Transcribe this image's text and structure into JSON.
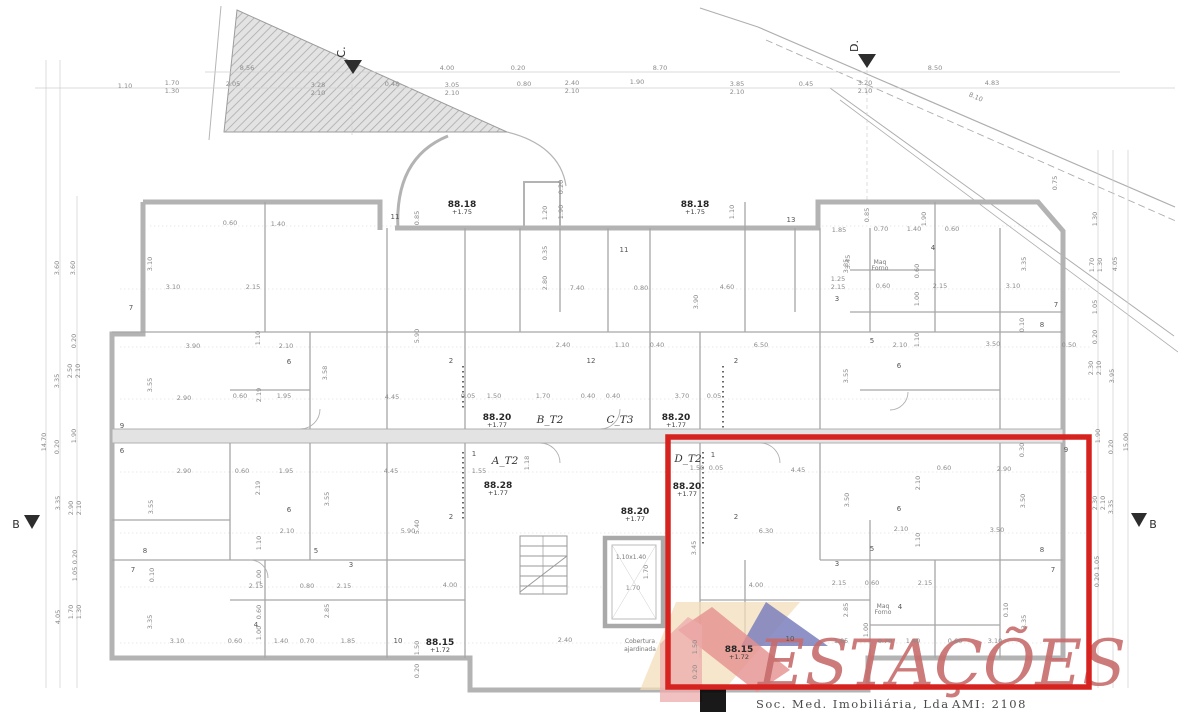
{
  "page": {
    "background": "#ffffff"
  },
  "highlight": {
    "color": "#d6231f"
  },
  "section_markers": {
    "c": "C.",
    "d": "D.",
    "b_left": "B",
    "b_right": "B"
  },
  "logo": {
    "name": "ESTAÇÕES",
    "line1": "Soc. Med. Imobiliária, Lda",
    "line2": "AMI: 2108",
    "colors": {
      "text": "#c76c6c",
      "roof_blue": "#7b7fbc",
      "roof_red": "#e5908f",
      "roof_tan": "#f2ddb9",
      "wall_pink": "#ecabab"
    }
  },
  "plan": {
    "elevation_labels": [
      {
        "x": 462,
        "y": 207,
        "v": "88.18",
        "s": "+1.75"
      },
      {
        "x": 695,
        "y": 207,
        "v": "88.18",
        "s": "+1.75"
      },
      {
        "x": 497,
        "y": 420,
        "v": "88.20",
        "s": "+1.77"
      },
      {
        "x": 676,
        "y": 420,
        "v": "88.20",
        "s": "+1.77"
      },
      {
        "x": 498,
        "y": 488,
        "v": "88.28",
        "s": "+1.77"
      },
      {
        "x": 687,
        "y": 489,
        "v": "88.20",
        "s": "+1.77"
      },
      {
        "x": 635,
        "y": 514,
        "v": "88.20",
        "s": "+1.77"
      },
      {
        "x": 440,
        "y": 645,
        "v": "88.15",
        "s": "+1.72"
      },
      {
        "x": 739,
        "y": 652,
        "v": "88.15",
        "s": "+1.72"
      }
    ],
    "apartment_labels": [
      {
        "x": 505,
        "y": 464,
        "t": "A_T2"
      },
      {
        "x": 550,
        "y": 423,
        "t": "B_T2"
      },
      {
        "x": 620,
        "y": 423,
        "t": "C_T3"
      },
      {
        "x": 688,
        "y": 462,
        "t": "D_T2"
      }
    ],
    "room_numbers": [
      {
        "x": 131,
        "y": 310,
        "t": "7"
      },
      {
        "x": 395,
        "y": 219,
        "t": "11"
      },
      {
        "x": 624,
        "y": 252,
        "t": "11"
      },
      {
        "x": 791,
        "y": 222,
        "t": "13"
      },
      {
        "x": 591,
        "y": 363,
        "t": "12"
      },
      {
        "x": 736,
        "y": 363,
        "t": "2"
      },
      {
        "x": 837,
        "y": 301,
        "t": "3"
      },
      {
        "x": 933,
        "y": 250,
        "t": "4"
      },
      {
        "x": 1056,
        "y": 307,
        "t": "7"
      },
      {
        "x": 1042,
        "y": 327,
        "t": "8"
      },
      {
        "x": 872,
        "y": 343,
        "t": "5"
      },
      {
        "x": 899,
        "y": 368,
        "t": "6"
      },
      {
        "x": 122,
        "y": 428,
        "t": "9"
      },
      {
        "x": 122,
        "y": 453,
        "t": "6"
      },
      {
        "x": 289,
        "y": 364,
        "t": "6"
      },
      {
        "x": 451,
        "y": 363,
        "t": "2"
      },
      {
        "x": 474,
        "y": 456,
        "t": "1"
      },
      {
        "x": 451,
        "y": 519,
        "t": "2"
      },
      {
        "x": 289,
        "y": 512,
        "t": "6"
      },
      {
        "x": 316,
        "y": 553,
        "t": "5"
      },
      {
        "x": 351,
        "y": 567,
        "t": "3"
      },
      {
        "x": 145,
        "y": 553,
        "t": "8"
      },
      {
        "x": 133,
        "y": 572,
        "t": "7"
      },
      {
        "x": 256,
        "y": 627,
        "t": "4"
      },
      {
        "x": 398,
        "y": 643,
        "t": "10"
      },
      {
        "x": 713,
        "y": 457,
        "t": "1"
      },
      {
        "x": 736,
        "y": 519,
        "t": "2"
      },
      {
        "x": 899,
        "y": 511,
        "t": "6"
      },
      {
        "x": 872,
        "y": 551,
        "t": "5"
      },
      {
        "x": 837,
        "y": 566,
        "t": "3"
      },
      {
        "x": 1042,
        "y": 552,
        "t": "8"
      },
      {
        "x": 1053,
        "y": 572,
        "t": "7"
      },
      {
        "x": 1066,
        "y": 452,
        "t": "9"
      },
      {
        "x": 900,
        "y": 609,
        "t": "4"
      },
      {
        "x": 790,
        "y": 641,
        "t": "10"
      }
    ],
    "dimensions": [
      {
        "x": 125,
        "y": 88,
        "t": "1.10"
      },
      {
        "x": 172,
        "y": 85,
        "t": "1.70"
      },
      {
        "x": 172,
        "y": 93,
        "t": "1.30"
      },
      {
        "x": 233,
        "y": 86,
        "t": "2.05"
      },
      {
        "x": 247,
        "y": 70,
        "t": "8.56"
      },
      {
        "x": 318,
        "y": 87,
        "t": "3.28"
      },
      {
        "x": 318,
        "y": 95,
        "t": "2.10"
      },
      {
        "x": 392,
        "y": 86,
        "t": "0.48"
      },
      {
        "x": 447,
        "y": 70,
        "t": "4.00"
      },
      {
        "x": 452,
        "y": 87,
        "t": "3.05"
      },
      {
        "x": 452,
        "y": 95,
        "t": "2.10"
      },
      {
        "x": 518,
        "y": 70,
        "t": "0.20"
      },
      {
        "x": 524,
        "y": 86,
        "t": "0.80"
      },
      {
        "x": 572,
        "y": 85,
        "t": "2.40"
      },
      {
        "x": 572,
        "y": 93,
        "t": "2.10"
      },
      {
        "x": 637,
        "y": 84,
        "t": "1.90"
      },
      {
        "x": 660,
        "y": 70,
        "t": "8.70"
      },
      {
        "x": 737,
        "y": 86,
        "t": "3.85"
      },
      {
        "x": 737,
        "y": 94,
        "t": "2.10"
      },
      {
        "x": 806,
        "y": 86,
        "t": "0.45"
      },
      {
        "x": 865,
        "y": 85,
        "t": "3.20"
      },
      {
        "x": 865,
        "y": 93,
        "t": "2.10"
      },
      {
        "x": 935,
        "y": 70,
        "t": "8.50"
      },
      {
        "x": 992,
        "y": 85,
        "t": "4.83"
      },
      {
        "x": 975,
        "y": 99,
        "t": "8.10",
        "r": 23
      },
      {
        "x": 59,
        "y": 268,
        "t": "3.60",
        "r": -90
      },
      {
        "x": 75,
        "y": 268,
        "t": "3.60",
        "r": -90
      },
      {
        "x": 76,
        "y": 341,
        "t": "0.20",
        "r": -90
      },
      {
        "x": 72,
        "y": 371,
        "t": "2.50",
        "r": -90
      },
      {
        "x": 80,
        "y": 371,
        "t": "2.10",
        "r": -90
      },
      {
        "x": 59,
        "y": 381,
        "t": "3.35",
        "r": -90
      },
      {
        "x": 76,
        "y": 436,
        "t": "1.90",
        "r": -90
      },
      {
        "x": 59,
        "y": 447,
        "t": "0.20",
        "r": -90
      },
      {
        "x": 46,
        "y": 442,
        "t": "14.70",
        "r": -90
      },
      {
        "x": 60,
        "y": 503,
        "t": "3.35",
        "r": -90
      },
      {
        "x": 73,
        "y": 508,
        "t": "2.90",
        "r": -90
      },
      {
        "x": 81,
        "y": 508,
        "t": "2.10",
        "r": -90
      },
      {
        "x": 77,
        "y": 557,
        "t": "0.20",
        "r": -90
      },
      {
        "x": 77,
        "y": 574,
        "t": "1.05",
        "r": -90
      },
      {
        "x": 73,
        "y": 612,
        "t": "1.70",
        "r": -90
      },
      {
        "x": 81,
        "y": 612,
        "t": "1.30",
        "r": -90
      },
      {
        "x": 60,
        "y": 617,
        "t": "4.05",
        "r": -90
      },
      {
        "x": 1057,
        "y": 183,
        "t": "0.75",
        "r": -90
      },
      {
        "x": 1097,
        "y": 219,
        "t": "1.30",
        "r": -90
      },
      {
        "x": 1094,
        "y": 265,
        "t": "1.70",
        "r": -90
      },
      {
        "x": 1102,
        "y": 265,
        "t": "1.30",
        "r": -90
      },
      {
        "x": 1117,
        "y": 264,
        "t": "4.05",
        "r": -90
      },
      {
        "x": 1097,
        "y": 307,
        "t": "1.05",
        "r": -90
      },
      {
        "x": 1097,
        "y": 337,
        "t": "0.20",
        "r": -90
      },
      {
        "x": 1093,
        "y": 368,
        "t": "2.30",
        "r": -90
      },
      {
        "x": 1101,
        "y": 368,
        "t": "2.10",
        "r": -90
      },
      {
        "x": 1114,
        "y": 376,
        "t": "3.95",
        "r": -90
      },
      {
        "x": 1100,
        "y": 436,
        "t": "1.90",
        "r": -90
      },
      {
        "x": 1113,
        "y": 447,
        "t": "0.20",
        "r": -90
      },
      {
        "x": 1128,
        "y": 442,
        "t": "15.00",
        "r": -90
      },
      {
        "x": 1097,
        "y": 503,
        "t": "2.30",
        "r": -90
      },
      {
        "x": 1105,
        "y": 503,
        "t": "2.10",
        "r": -90
      },
      {
        "x": 1113,
        "y": 507,
        "t": "3.35",
        "r": -90
      },
      {
        "x": 1099,
        "y": 563,
        "t": "1.05",
        "r": -90
      },
      {
        "x": 1099,
        "y": 580,
        "t": "0.20",
        "r": -90
      },
      {
        "x": 173,
        "y": 289,
        "t": "3.10"
      },
      {
        "x": 253,
        "y": 289,
        "t": "2.15"
      },
      {
        "x": 152,
        "y": 264,
        "t": "3.10",
        "r": -90
      },
      {
        "x": 230,
        "y": 225,
        "t": "0.60"
      },
      {
        "x": 278,
        "y": 226,
        "t": "1.40"
      },
      {
        "x": 419,
        "y": 218,
        "t": "0.85",
        "r": -90
      },
      {
        "x": 547,
        "y": 213,
        "t": "1.20",
        "r": -90
      },
      {
        "x": 563,
        "y": 212,
        "t": "1.90",
        "r": -90
      },
      {
        "x": 563,
        "y": 187,
        "t": "0.20",
        "r": -90
      },
      {
        "x": 734,
        "y": 212,
        "t": "1.10",
        "r": -90
      },
      {
        "x": 869,
        "y": 215,
        "t": "0.85",
        "r": -90
      },
      {
        "x": 881,
        "y": 231,
        "t": "0.70"
      },
      {
        "x": 914,
        "y": 231,
        "t": "1.40"
      },
      {
        "x": 952,
        "y": 231,
        "t": "0.60"
      },
      {
        "x": 926,
        "y": 219,
        "t": "1.90",
        "r": -90
      },
      {
        "x": 547,
        "y": 253,
        "t": "0.35",
        "r": -90
      },
      {
        "x": 547,
        "y": 283,
        "t": "2.80",
        "r": -90
      },
      {
        "x": 577,
        "y": 290,
        "t": "7.40"
      },
      {
        "x": 641,
        "y": 290,
        "t": "0.80"
      },
      {
        "x": 727,
        "y": 289,
        "t": "4.60"
      },
      {
        "x": 698,
        "y": 302,
        "t": "3.90",
        "r": -90
      },
      {
        "x": 848,
        "y": 266,
        "t": "3.85",
        "r": -90
      },
      {
        "x": 839,
        "y": 232,
        "t": "1.85"
      },
      {
        "x": 883,
        "y": 288,
        "t": "0.60"
      },
      {
        "x": 940,
        "y": 288,
        "t": "2.15"
      },
      {
        "x": 1013,
        "y": 288,
        "t": "3.10"
      },
      {
        "x": 1026,
        "y": 264,
        "t": "3.35",
        "r": -90
      },
      {
        "x": 919,
        "y": 271,
        "t": "0.60",
        "r": -90
      },
      {
        "x": 919,
        "y": 299,
        "t": "1.00",
        "r": -90
      },
      {
        "x": 850,
        "y": 262,
        "t": "3.45",
        "r": -90
      },
      {
        "x": 563,
        "y": 347,
        "t": "2.40"
      },
      {
        "x": 622,
        "y": 347,
        "t": "1.10"
      },
      {
        "x": 657,
        "y": 347,
        "t": "0.40"
      },
      {
        "x": 761,
        "y": 347,
        "t": "6.50"
      },
      {
        "x": 848,
        "y": 376,
        "t": "3.55",
        "r": -90
      },
      {
        "x": 838,
        "y": 281,
        "t": "1.25"
      },
      {
        "x": 838,
        "y": 289,
        "t": "2.15"
      },
      {
        "x": 1024,
        "y": 325,
        "t": "0.10",
        "r": -90
      },
      {
        "x": 900,
        "y": 347,
        "t": "2.10"
      },
      {
        "x": 993,
        "y": 346,
        "t": "3.50"
      },
      {
        "x": 1069,
        "y": 347,
        "t": "0.50"
      },
      {
        "x": 919,
        "y": 340,
        "t": "1.10",
        "r": -90
      },
      {
        "x": 193,
        "y": 348,
        "t": "3.90"
      },
      {
        "x": 286,
        "y": 348,
        "t": "2.10"
      },
      {
        "x": 260,
        "y": 338,
        "t": "1.10",
        "r": -90
      },
      {
        "x": 152,
        "y": 385,
        "t": "3.55",
        "r": -90
      },
      {
        "x": 184,
        "y": 400,
        "t": "2.90"
      },
      {
        "x": 240,
        "y": 398,
        "t": "0.60"
      },
      {
        "x": 261,
        "y": 395,
        "t": "2.19",
        "r": -90
      },
      {
        "x": 284,
        "y": 398,
        "t": "1.95"
      },
      {
        "x": 392,
        "y": 399,
        "t": "4.45"
      },
      {
        "x": 419,
        "y": 336,
        "t": "5.90",
        "r": -90
      },
      {
        "x": 327,
        "y": 373,
        "t": "3.58",
        "r": -90
      },
      {
        "x": 468,
        "y": 398,
        "t": "0.05"
      },
      {
        "x": 494,
        "y": 398,
        "t": "1.50"
      },
      {
        "x": 543,
        "y": 398,
        "t": "1.70"
      },
      {
        "x": 588,
        "y": 398,
        "t": "0.40"
      },
      {
        "x": 613,
        "y": 398,
        "t": "0.40"
      },
      {
        "x": 682,
        "y": 398,
        "t": "3.70"
      },
      {
        "x": 714,
        "y": 398,
        "t": "0.05"
      },
      {
        "x": 184,
        "y": 473,
        "t": "2.90"
      },
      {
        "x": 242,
        "y": 473,
        "t": "0.60"
      },
      {
        "x": 286,
        "y": 473,
        "t": "1.95"
      },
      {
        "x": 391,
        "y": 473,
        "t": "4.45"
      },
      {
        "x": 479,
        "y": 473,
        "t": "1.55"
      },
      {
        "x": 529,
        "y": 463,
        "t": "1.18",
        "r": -90
      },
      {
        "x": 260,
        "y": 488,
        "t": "2.19",
        "r": -90
      },
      {
        "x": 153,
        "y": 507,
        "t": "3.55",
        "r": -90
      },
      {
        "x": 329,
        "y": 499,
        "t": "3.55",
        "r": -90
      },
      {
        "x": 287,
        "y": 533,
        "t": "2.10"
      },
      {
        "x": 408,
        "y": 533,
        "t": "5.90"
      },
      {
        "x": 419,
        "y": 527,
        "t": "5.40",
        "r": -90
      },
      {
        "x": 261,
        "y": 543,
        "t": "1.10",
        "r": -90
      },
      {
        "x": 697,
        "y": 470,
        "t": "1.50"
      },
      {
        "x": 716,
        "y": 470,
        "t": "0.05"
      },
      {
        "x": 798,
        "y": 472,
        "t": "4.45"
      },
      {
        "x": 944,
        "y": 470,
        "t": "0.60"
      },
      {
        "x": 1004,
        "y": 471,
        "t": "2.90"
      },
      {
        "x": 920,
        "y": 483,
        "t": "2.10",
        "r": -90
      },
      {
        "x": 1025,
        "y": 501,
        "t": "3.50",
        "r": -90
      },
      {
        "x": 1024,
        "y": 450,
        "t": "0.30",
        "r": -90
      },
      {
        "x": 766,
        "y": 533,
        "t": "6.30"
      },
      {
        "x": 901,
        "y": 531,
        "t": "2.10"
      },
      {
        "x": 997,
        "y": 532,
        "t": "3.50"
      },
      {
        "x": 920,
        "y": 540,
        "t": "1.10",
        "r": -90
      },
      {
        "x": 696,
        "y": 548,
        "t": "3.45",
        "r": -90
      },
      {
        "x": 849,
        "y": 500,
        "t": "3.50",
        "r": -90
      },
      {
        "x": 177,
        "y": 643,
        "t": "3.10"
      },
      {
        "x": 235,
        "y": 643,
        "t": "0.60"
      },
      {
        "x": 281,
        "y": 643,
        "t": "1.40"
      },
      {
        "x": 307,
        "y": 643,
        "t": "0.70"
      },
      {
        "x": 348,
        "y": 643,
        "t": "1.85"
      },
      {
        "x": 256,
        "y": 588,
        "t": "2.15"
      },
      {
        "x": 307,
        "y": 588,
        "t": "0.80"
      },
      {
        "x": 344,
        "y": 588,
        "t": "2.15"
      },
      {
        "x": 450,
        "y": 587,
        "t": "4.00"
      },
      {
        "x": 419,
        "y": 648,
        "t": "1.50",
        "r": -90
      },
      {
        "x": 419,
        "y": 671,
        "t": "0.20",
        "r": -90
      },
      {
        "x": 152,
        "y": 622,
        "t": "3.35",
        "r": -90
      },
      {
        "x": 154,
        "y": 575,
        "t": "0.10",
        "r": -90
      },
      {
        "x": 261,
        "y": 577,
        "t": "1.00",
        "r": -90
      },
      {
        "x": 261,
        "y": 612,
        "t": "0.60",
        "r": -90
      },
      {
        "x": 261,
        "y": 633,
        "t": "1.00",
        "r": -90
      },
      {
        "x": 329,
        "y": 611,
        "t": "2.85",
        "r": -90
      },
      {
        "x": 565,
        "y": 642,
        "t": "2.40"
      },
      {
        "x": 633,
        "y": 590,
        "t": "1.70"
      },
      {
        "x": 648,
        "y": 572,
        "t": "1.70",
        "r": -90
      },
      {
        "x": 756,
        "y": 587,
        "t": "4.00"
      },
      {
        "x": 839,
        "y": 585,
        "t": "2.15"
      },
      {
        "x": 872,
        "y": 585,
        "t": "0.60"
      },
      {
        "x": 925,
        "y": 585,
        "t": "2.15"
      },
      {
        "x": 841,
        "y": 643,
        "t": "1.85"
      },
      {
        "x": 885,
        "y": 643,
        "t": "0.70"
      },
      {
        "x": 913,
        "y": 643,
        "t": "1.40"
      },
      {
        "x": 955,
        "y": 643,
        "t": "0.60"
      },
      {
        "x": 995,
        "y": 643,
        "t": "3.10"
      },
      {
        "x": 1026,
        "y": 622,
        "t": "3.35",
        "r": -90
      },
      {
        "x": 848,
        "y": 610,
        "t": "2.85",
        "r": -90
      },
      {
        "x": 868,
        "y": 630,
        "t": "1.00",
        "r": -90
      },
      {
        "x": 697,
        "y": 647,
        "t": "1.50",
        "r": -90
      },
      {
        "x": 697,
        "y": 672,
        "t": "0.20",
        "r": -90
      },
      {
        "x": 1008,
        "y": 610,
        "t": "0.10",
        "r": -90
      }
    ],
    "notes": [
      {
        "x": 640,
        "y": 643,
        "t": "Cobertura"
      },
      {
        "x": 640,
        "y": 651,
        "t": "ajardinada"
      },
      {
        "x": 631,
        "y": 559,
        "t": "1.10x1.40"
      },
      {
        "x": 880,
        "y": 264,
        "t": "Maq"
      },
      {
        "x": 880,
        "y": 270,
        "t": "Forno"
      },
      {
        "x": 883,
        "y": 608,
        "t": "Maq"
      },
      {
        "x": 883,
        "y": 614,
        "t": "Forno"
      }
    ]
  }
}
